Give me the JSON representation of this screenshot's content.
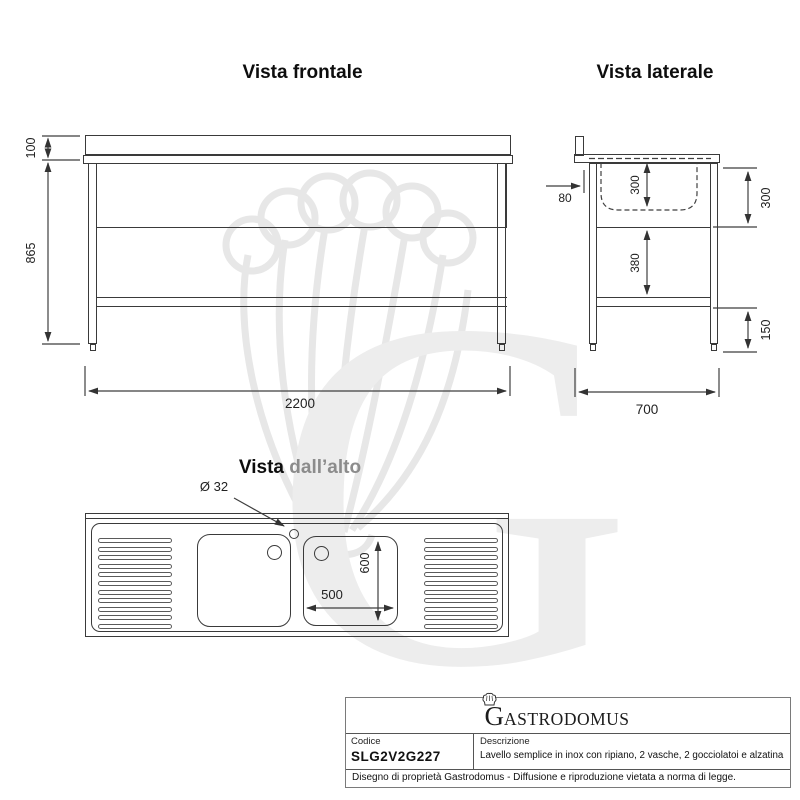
{
  "views": {
    "front": {
      "title": "Vista frontale",
      "dim_backsplash_height": "100",
      "dim_body_height": "865",
      "dim_width": "2200"
    },
    "side": {
      "title": "Vista laterale",
      "dim_splash_offset": "80",
      "dim_bowl_depth": "300",
      "dim_upper_height": "300",
      "dim_mid_height": "380",
      "dim_lower_height": "150",
      "dim_depth": "700"
    },
    "top": {
      "title_prefix": "Vista",
      "title_suffix": "dall’alto",
      "tap_hole_label": "Ø 32",
      "dim_bowl_width": "500",
      "dim_bowl_length": "600"
    }
  },
  "title_block": {
    "logo_initial": "G",
    "logo_rest": "ASTRODOMUS",
    "code_label": "Codice",
    "code_value": "SLG2V2G227",
    "description_label": "Descrizione",
    "description_value": "Lavello semplice in inox con ripiano, 2 vasche, 2 gocciolatoi e alzatina",
    "footer": "Disegno di proprietà Gastrodomus -  Diffusione e riproduzione vietata a norma di legge."
  },
  "watermark": {
    "letter": "G"
  },
  "colors": {
    "line": "#3a3a3a",
    "dimension": "#3f3f3f",
    "title_gray": "#8c8c8c",
    "watermark": "#ececec"
  }
}
